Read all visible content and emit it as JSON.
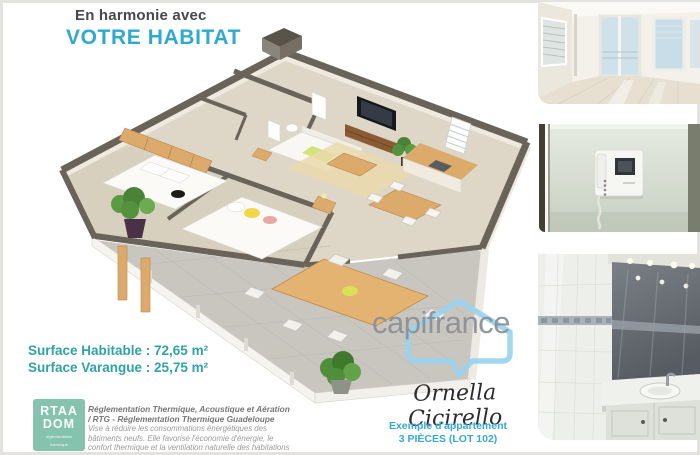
{
  "header": {
    "line1": "En harmonie avec",
    "line2": "VOTRE HABITAT",
    "accent_color": "#2fa9cf"
  },
  "surfaces": {
    "habitable": "Surface Habitable : 72,65 m²",
    "varangue": "Surface Varangue : 25,75 m²",
    "color": "#2fa3a5"
  },
  "badge": {
    "line1": "RTAA",
    "line2": "DOM",
    "sub1": "réglementation",
    "sub2": "thermique",
    "bg_color": "#86c3ae"
  },
  "regulation": {
    "bold1": "Réglementation Thermique, Acoustique et Aération",
    "bold2": "/ RTG - Réglementation Thermique Guadeloupe",
    "body1": "Vise à réduire les consommations énergétiques des",
    "body2": "bâtiments neufs. Elle favorise l'économie d'énergie, le",
    "body3": "confort thermique et la ventilation naturelle des habitations"
  },
  "watermark": {
    "text": "capifrance",
    "text_color": "#8b9097",
    "bubble_color": "#98d3ee"
  },
  "signature": {
    "text": "Ornella Cicirello"
  },
  "caption": {
    "line1": "Exemple d'appartement",
    "line2": "3 PIÈCES (LOT 102)",
    "color": "#35a9d3"
  },
  "floor_plan_colors": {
    "wall_top": "#6a6359",
    "wall_face": "#efe9df",
    "interior_floor": "#ded6c6",
    "terrace_floor": "#c9c6c0",
    "wood": "#dcab6b"
  }
}
